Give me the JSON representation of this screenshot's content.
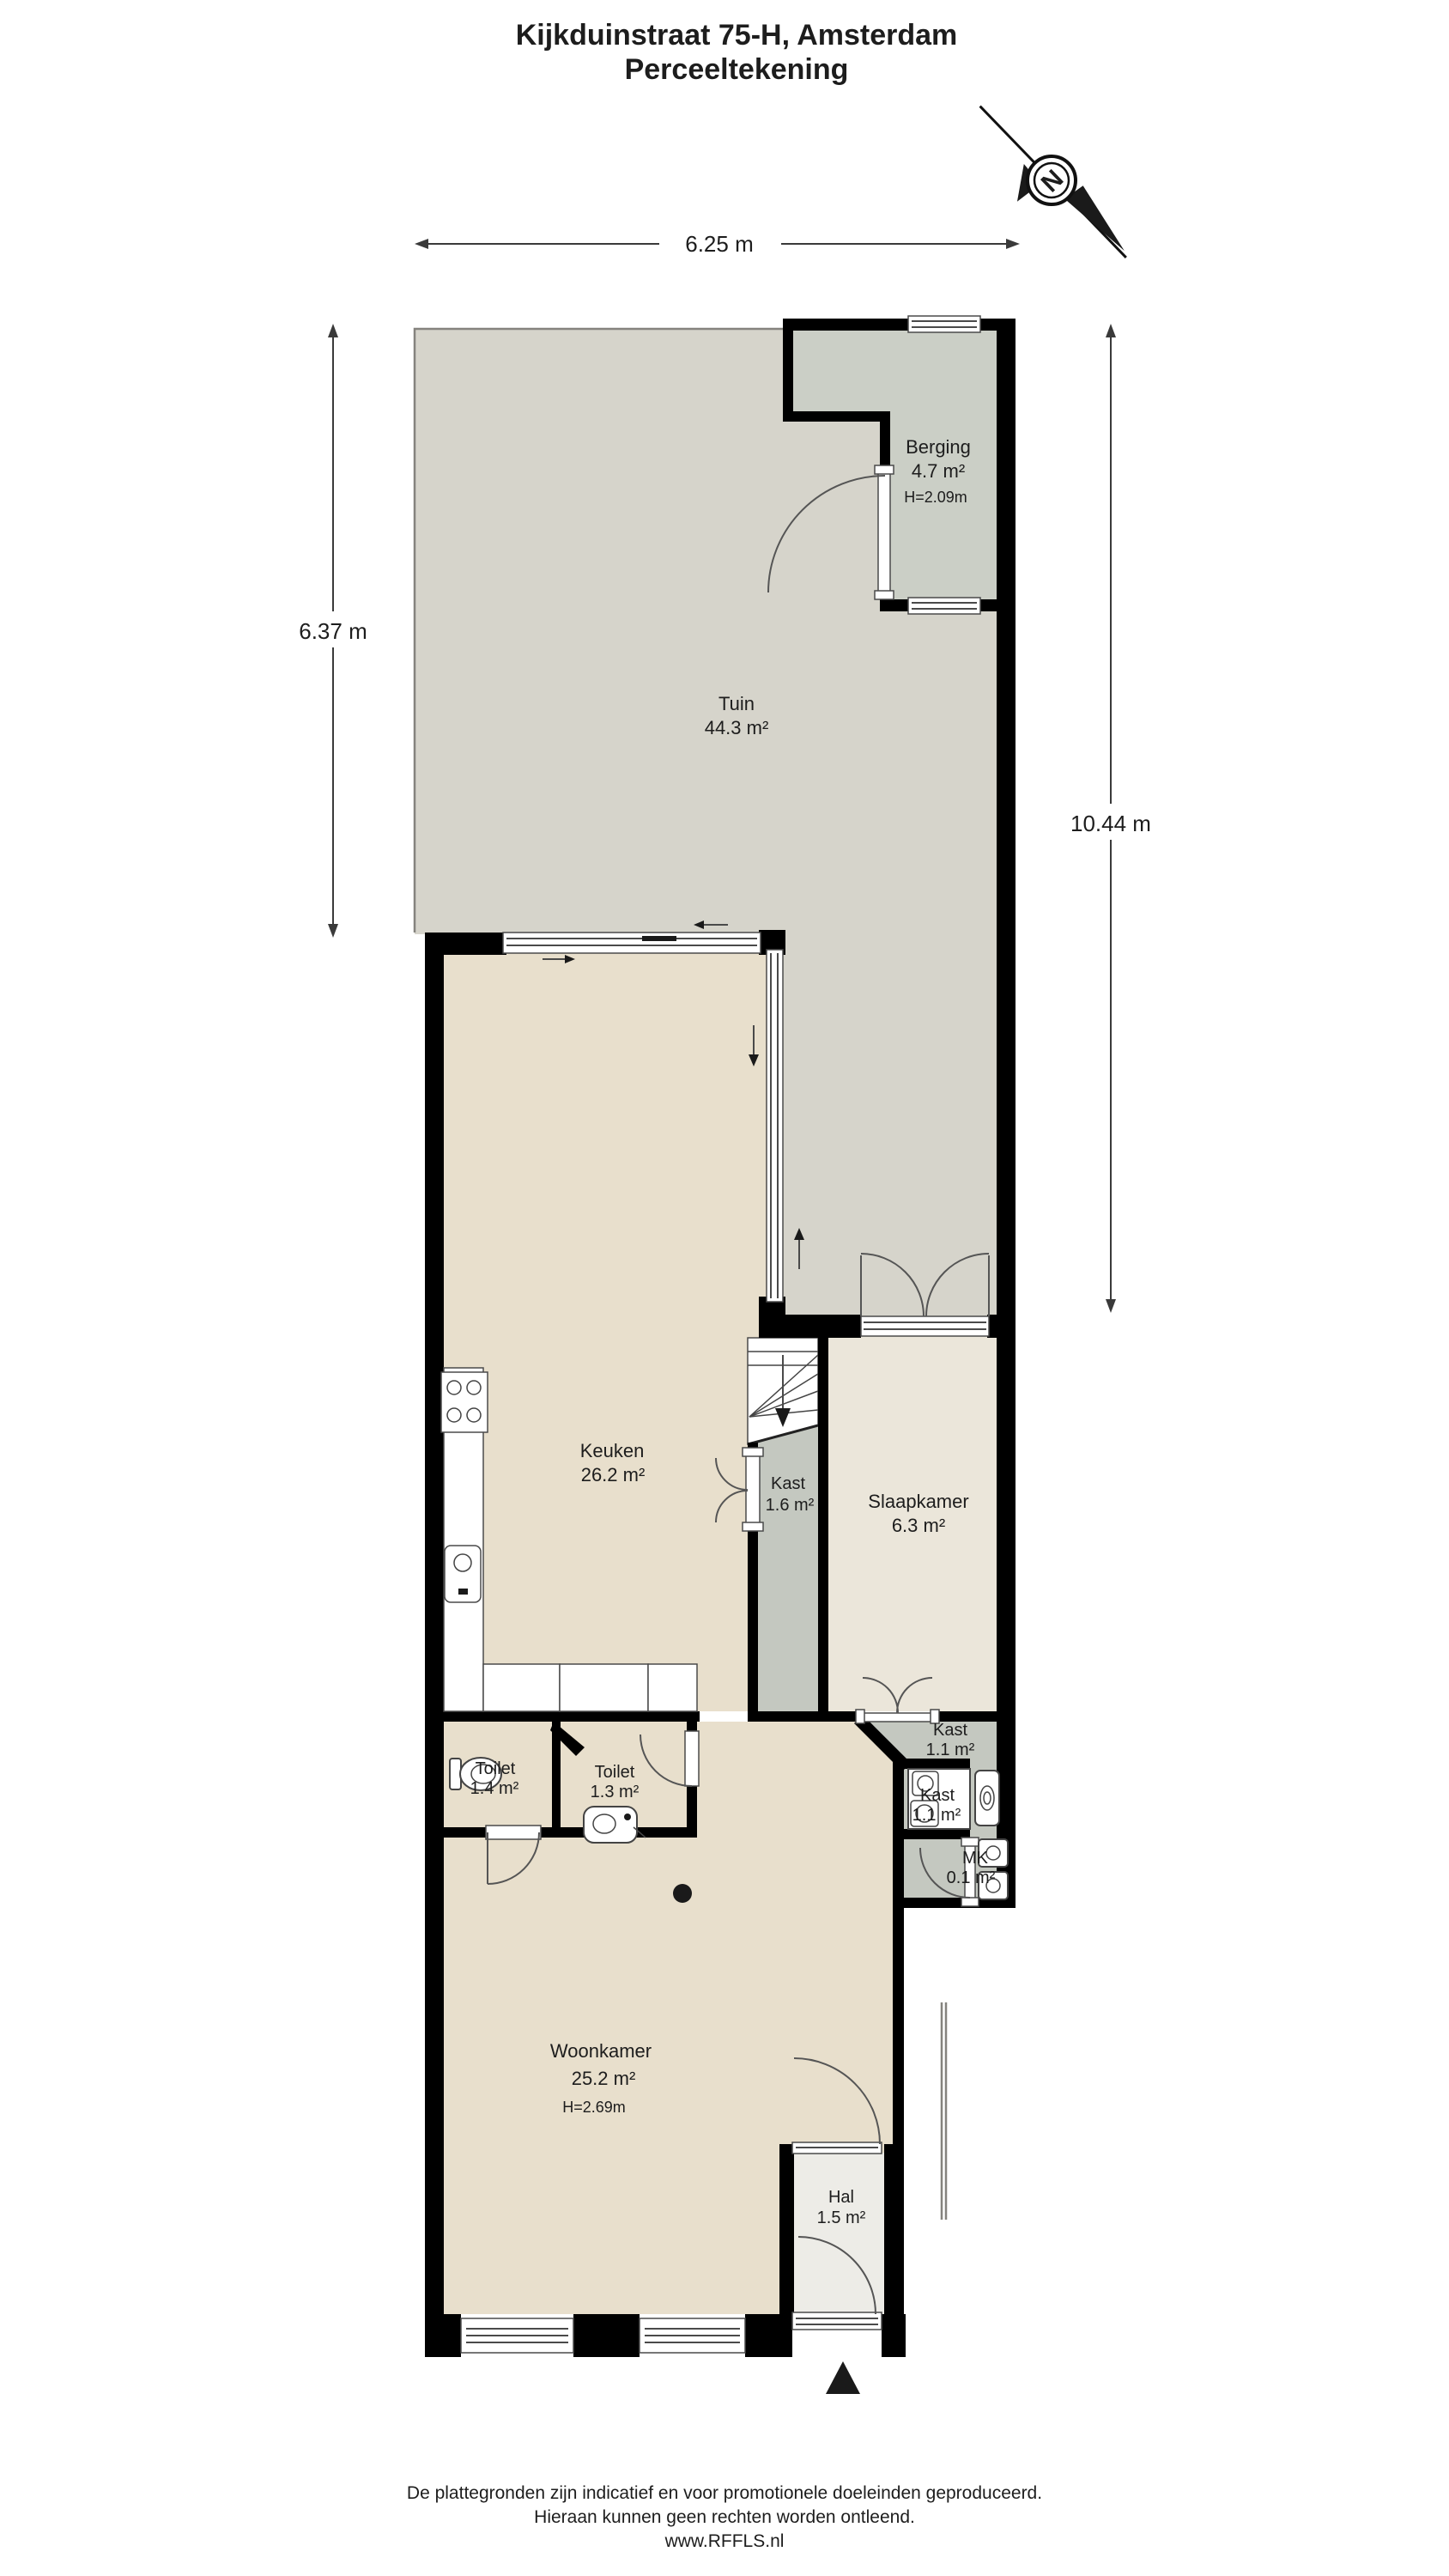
{
  "title": {
    "line1": "Kijkduinstraat 75-H, Amsterdam",
    "line2": "Perceeltekening"
  },
  "compass": {
    "north_label": "N"
  },
  "dimensions": {
    "width_top": "6.25 m",
    "depth_left": "6.37 m",
    "depth_right": "10.44 m"
  },
  "rooms": {
    "tuin": {
      "name": "Tuin",
      "area": "44.3 m²"
    },
    "berging": {
      "name": "Berging",
      "area": "4.7 m²",
      "ceiling": "H=2.09m"
    },
    "keuken": {
      "name": "Keuken",
      "area": "26.2 m²"
    },
    "kast_trap": {
      "name": "Kast",
      "area": "1.6 m²"
    },
    "slaapkamer": {
      "name": "Slaapkamer",
      "area": "6.3 m²"
    },
    "kast_slaapkamer": {
      "name": "Kast",
      "area": "1.1 m²"
    },
    "kast_wasruimte": {
      "name": "Kast",
      "area": "1.1 m²"
    },
    "meterkast": {
      "name": "MK",
      "area": "0.1 m²"
    },
    "toilet_1": {
      "name": "Toilet",
      "area": "1.4 m²"
    },
    "toilet_2": {
      "name": "Toilet",
      "area": "1.3 m²"
    },
    "woonkamer": {
      "name": "Woonkamer",
      "area": "25.2 m²",
      "ceiling": "H=2.69m"
    },
    "hal": {
      "name": "Hal",
      "area": "1.5 m²"
    }
  },
  "footer": {
    "line1": "De plattegronden zijn indicatief en voor promotionele doeleinden geproduceerd.",
    "line2": "Hieraan kunnen geen rechten worden ontleend.",
    "line3": "www.RFFLS.nl"
  },
  "colors": {
    "wall": "#000000",
    "tuin_fill": "#d6d4cb",
    "berging_fill": "#cbcfc6",
    "floor_beige": "#e8dfcc",
    "floor_cream": "#ebe6da",
    "closet_gray": "#c4c8c0",
    "hal_fill": "#edece7"
  }
}
